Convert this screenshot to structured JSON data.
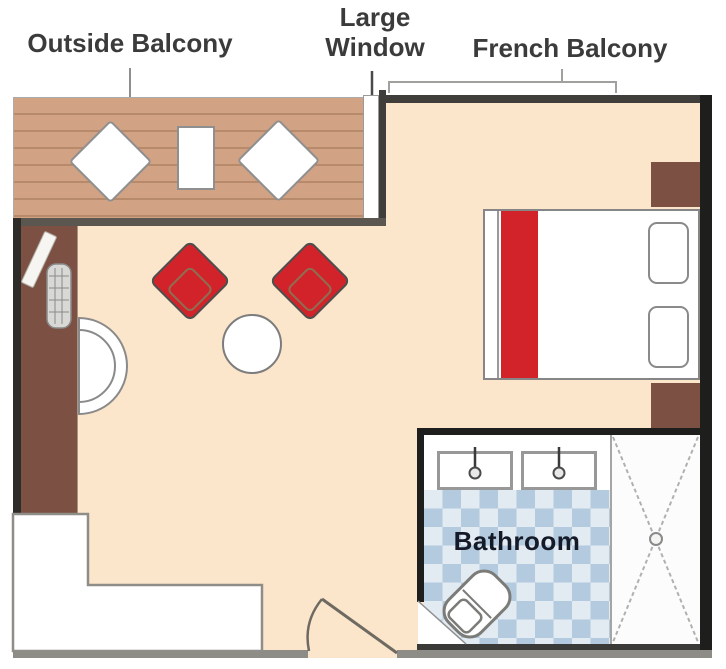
{
  "plan": {
    "labels": {
      "outside_balcony": "Outside Balcony",
      "large_window_line1": "Large",
      "large_window_line2": "Window",
      "french_balcony": "French Balcony",
      "bathroom": "Bathroom"
    },
    "colors": {
      "floor": "#fce6cb",
      "deck_wood": "#d2a284",
      "deck_plank_line": "#b68a6b",
      "furniture_brown": "#7c5144",
      "accent_red": "#d2232a",
      "tile_blue": "#b4cade",
      "tile_light": "#e2eaf2",
      "wall_dark": "#3f3e3b",
      "wall_black": "#1e1e1c",
      "wall_gray": "#8e8c86",
      "outline_gray": "#8b8b8b",
      "label_text": "#3b3b3b",
      "bathroom_text": "#141a28"
    },
    "icons": {
      "balcony-chair": "white diamond",
      "balcony-table": "white rectangle",
      "lounge-chair": "red diamond with cushion outline",
      "coffee-table": "white circle",
      "bed": "rectangle with red runner",
      "pillow": "rounded rectangle",
      "sink": "rectangle with faucet dot",
      "toilet": "rotated rounded rectangle",
      "shower": "dashed X with drain circle",
      "door-swing": "arc with leaf line"
    }
  }
}
